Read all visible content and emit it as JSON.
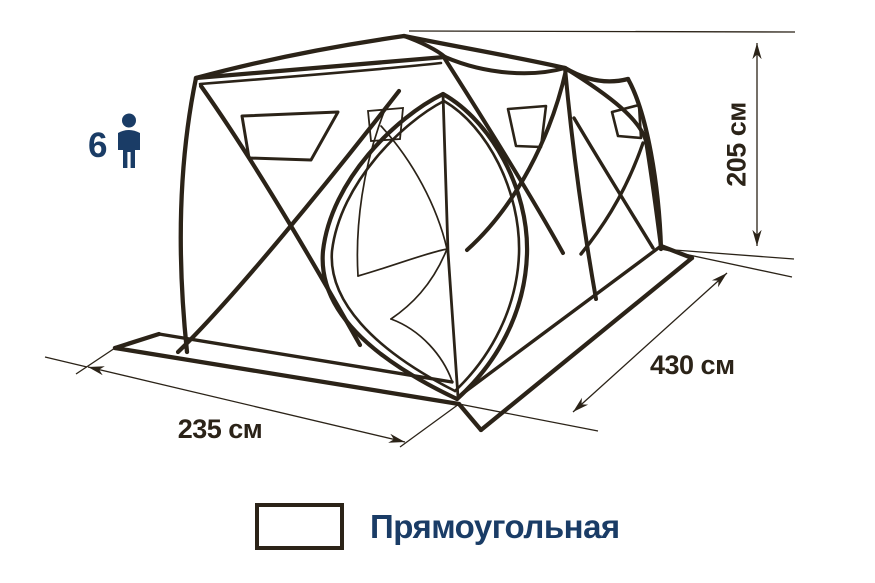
{
  "capacity": {
    "count": "6",
    "icon": "person-silhouette"
  },
  "dimensions": {
    "height": "205 см",
    "length": "430 см",
    "width": "235 см"
  },
  "legend": {
    "base_shape_label": "Прямоугольная",
    "swatch_shape": "rectangle"
  },
  "colors": {
    "line_art": "#2b2318",
    "navy": "#1a3c66"
  }
}
